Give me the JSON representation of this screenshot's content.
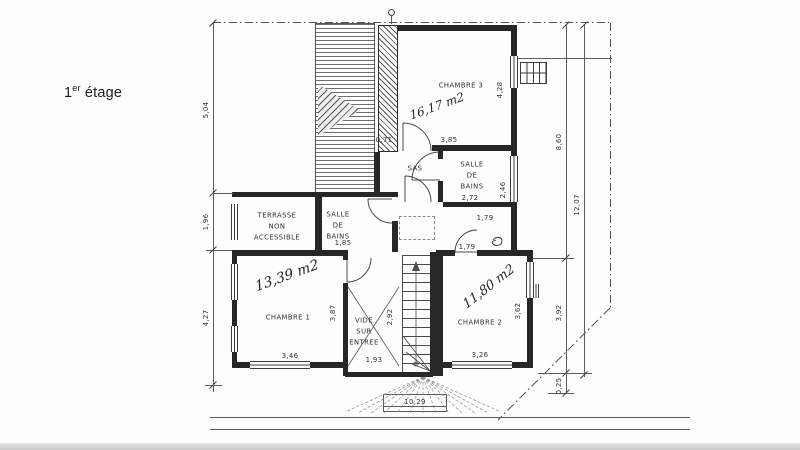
{
  "page": {
    "floor_label": {
      "num": "1",
      "sup": "er",
      "word": " étage"
    },
    "paper_color": "#fdfdfc",
    "ink_color": "#2e2e2e"
  },
  "plan": {
    "rooms": [
      {
        "label": "CHAMBRE 3",
        "x": 461,
        "y": 86
      },
      {
        "label": "SAS",
        "x": 415,
        "y": 169
      },
      {
        "label": "SALLE\nDE\nBAINS",
        "x": 472,
        "y": 176
      },
      {
        "label": "TERRASSE\nNON\nACCESSIBLE",
        "x": 277,
        "y": 227
      },
      {
        "label": "SALLE\nDE\nBAINS",
        "x": 338,
        "y": 226
      },
      {
        "label": "CHAMBRE 1",
        "x": 288,
        "y": 318
      },
      {
        "label": "VIDE\nSUR\nENTREE",
        "x": 364,
        "y": 332
      },
      {
        "label": "CHAMBRE 2",
        "x": 480,
        "y": 323
      }
    ],
    "areas": [
      {
        "text": "16,17 m2",
        "x": 437,
        "y": 106,
        "rot": -20,
        "size": 12
      },
      {
        "text": "13,39 m2",
        "x": 287,
        "y": 276,
        "rot": -20,
        "size": 14
      },
      {
        "text": "11,80 m2",
        "x": 489,
        "y": 287,
        "rot": -38,
        "size": 13
      }
    ],
    "dimensions": [
      {
        "text": "5,04",
        "x": 206,
        "y": 110,
        "rot": -90
      },
      {
        "text": "1,96",
        "x": 206,
        "y": 222,
        "rot": -90
      },
      {
        "text": "4,27",
        "x": 206,
        "y": 318,
        "rot": -90
      },
      {
        "text": "8,60",
        "x": 559,
        "y": 142,
        "rot": -90
      },
      {
        "text": "12,07",
        "x": 577,
        "y": 205,
        "rot": -90
      },
      {
        "text": "3,92",
        "x": 559,
        "y": 313,
        "rot": -90
      },
      {
        "text": "0,25",
        "x": 559,
        "y": 386,
        "rot": -90
      },
      {
        "text": "4,28",
        "x": 500,
        "y": 90,
        "rot": -90
      },
      {
        "text": "2,46",
        "x": 503,
        "y": 190,
        "rot": -90
      },
      {
        "text": "3,87",
        "x": 333,
        "y": 313,
        "rot": -90
      },
      {
        "text": "2,92",
        "x": 390,
        "y": 317,
        "rot": -90
      },
      {
        "text": "3,62",
        "x": 518,
        "y": 311,
        "rot": -90
      },
      {
        "text": "3,85",
        "x": 449,
        "y": 140,
        "rot": 0
      },
      {
        "text": "0,71",
        "x": 384,
        "y": 140,
        "rot": 0
      },
      {
        "text": "2,72",
        "x": 470,
        "y": 198,
        "rot": 0
      },
      {
        "text": "1,79",
        "x": 485,
        "y": 218,
        "rot": 0
      },
      {
        "text": "1,79",
        "x": 467,
        "y": 247,
        "rot": 0
      },
      {
        "text": "1,85",
        "x": 343,
        "y": 243,
        "rot": 0
      },
      {
        "text": "1,93",
        "x": 374,
        "y": 360,
        "rot": 0
      },
      {
        "text": "3,46",
        "x": 290,
        "y": 356,
        "rot": 0
      },
      {
        "text": "3,26",
        "x": 480,
        "y": 355,
        "rot": 0
      },
      {
        "text": "10,29",
        "x": 415,
        "y": 402,
        "rot": 0
      }
    ]
  }
}
